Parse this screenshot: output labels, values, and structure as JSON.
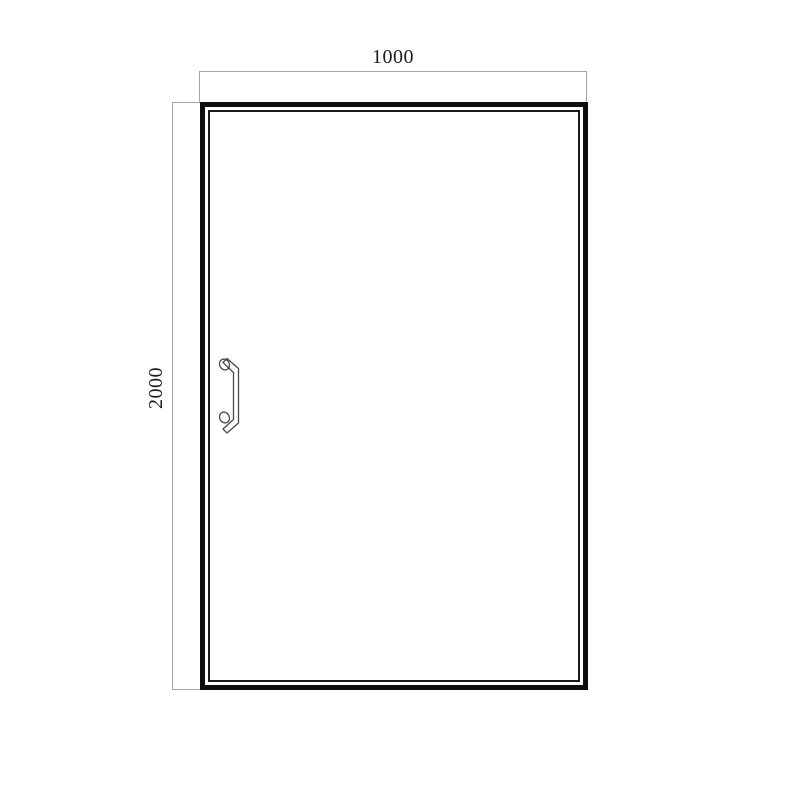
{
  "drawing": {
    "type": "door-technical-drawing",
    "dimension_labels": {
      "width": "1000",
      "height": "2000"
    },
    "icons": {
      "handle": "door-pull-handle-icon"
    },
    "colors": {
      "background": "#ffffff",
      "frame": "#0d0d0d",
      "panel_line": "#1a1a1a",
      "dimension_line": "#a3a3a3",
      "dimension_text": "#1b1b22",
      "handle": "#4a4a4a"
    }
  }
}
